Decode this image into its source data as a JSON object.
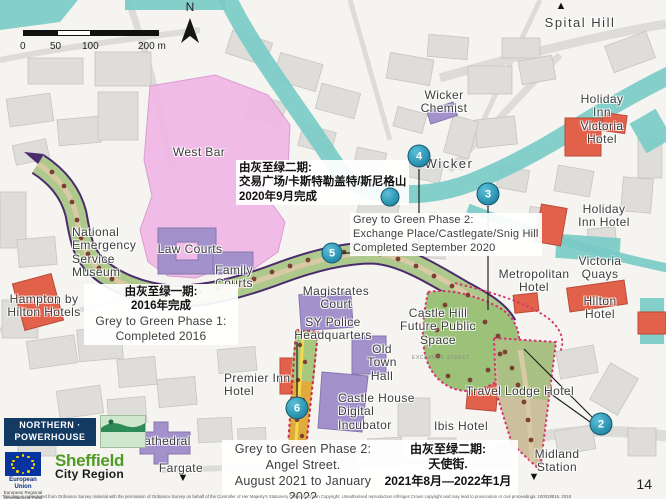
{
  "meta": {
    "page_number": "14"
  },
  "compass": {
    "north_label": "N"
  },
  "scale_bar": {
    "ticks": [
      "0",
      "50",
      "100",
      "200 m"
    ]
  },
  "map_labels": [
    {
      "text": "Spital Hill"
    },
    {
      "text": "Wicker\nChemist"
    },
    {
      "text": "Holiday Inn\nVictoria Hotel"
    },
    {
      "text": "Wicker"
    },
    {
      "text": "Holiday Inn Hotel"
    },
    {
      "text": "Victoria Quays"
    },
    {
      "text": "Metropolitan\nHotel"
    },
    {
      "text": "Hilton Hotel"
    },
    {
      "text": "West Bar"
    },
    {
      "text": "National\nEmergency\nService\nMuseum"
    },
    {
      "text": "Law Courts"
    },
    {
      "text": "Family\nCourts"
    },
    {
      "text": "Hampton by\nHilton Hotels"
    },
    {
      "text": "Magistrates\nCourt"
    },
    {
      "text": "SY Police\nHeadquarters"
    },
    {
      "text": "Castle Hill\nFuture Public\nSpace"
    },
    {
      "text": "Old\nTown\nHall"
    },
    {
      "text": "Premier Inn\nHotel"
    },
    {
      "text": "Castle House\nDigital\nIncubator"
    },
    {
      "text": "Travel Lodge Hotel"
    },
    {
      "text": "Ibis Hotel"
    },
    {
      "text": "Cathedral"
    },
    {
      "text": "Fargate"
    },
    {
      "text": "Midland\nStation"
    },
    {
      "text": "EXCHANGE STREET"
    }
  ],
  "annotations": {
    "castlegate_cn": {
      "l1": "由灰至绿二期:",
      "l2": "交易广场/卡斯特勒盖特/斯尼格山",
      "l3": "2020年9月完成"
    },
    "castlegate_en": {
      "l1": "Grey to Green Phase 2:",
      "l2": "Exchange Place/Castlegate/Snig Hill",
      "l3": "Completed September 2020"
    },
    "phase1": {
      "cn1": "由灰至绿一期:",
      "cn2": "2016年完成",
      "en1": "Grey to Green Phase 1:",
      "en2": "Completed 2016"
    },
    "angel": {
      "en1": "Grey to Green Phase 2:",
      "en2": "Angel Street.",
      "en3": "August 2021 to January 2022",
      "cn1": "由灰至绿二期:",
      "cn2": "天使街.",
      "cn3": "2021年8月—2022年1月"
    }
  },
  "markers": {
    "m1": "",
    "m2": "2",
    "m3": "3",
    "m4": "4",
    "m5": "5",
    "m6": "6"
  },
  "logos": {
    "northern_powerhouse": "NORTHERN ·\nPOWERHOUSE",
    "sheffield_council": "Sheffield\nCity Council",
    "eu_title": "European Union",
    "eu_sub": "European Regional\nDevelopment Fund",
    "scr_1": "Sheffield",
    "scr_2": "City Region"
  },
  "copyright": "This map is reproduced from Ordnance Survey material with the permission of Ordnance Survey on behalf of the Controller of Her Majesty's Stationery Office. © Crown Copyright. Unauthorised reproduction infringes Crown copyright and may lead to prosecution or civil proceedings. 100018816. 2018",
  "colors": {
    "marker": "#2d95b3",
    "river": "#79cbc7",
    "west_bar_area": "#f0b7e6",
    "civic_building": "#a391cc",
    "hotel_building": "#e2614b",
    "route_outline": "#4a2b6b",
    "green_corridor": "#aec98c",
    "phase_boundary_dash": "#d6336c"
  }
}
